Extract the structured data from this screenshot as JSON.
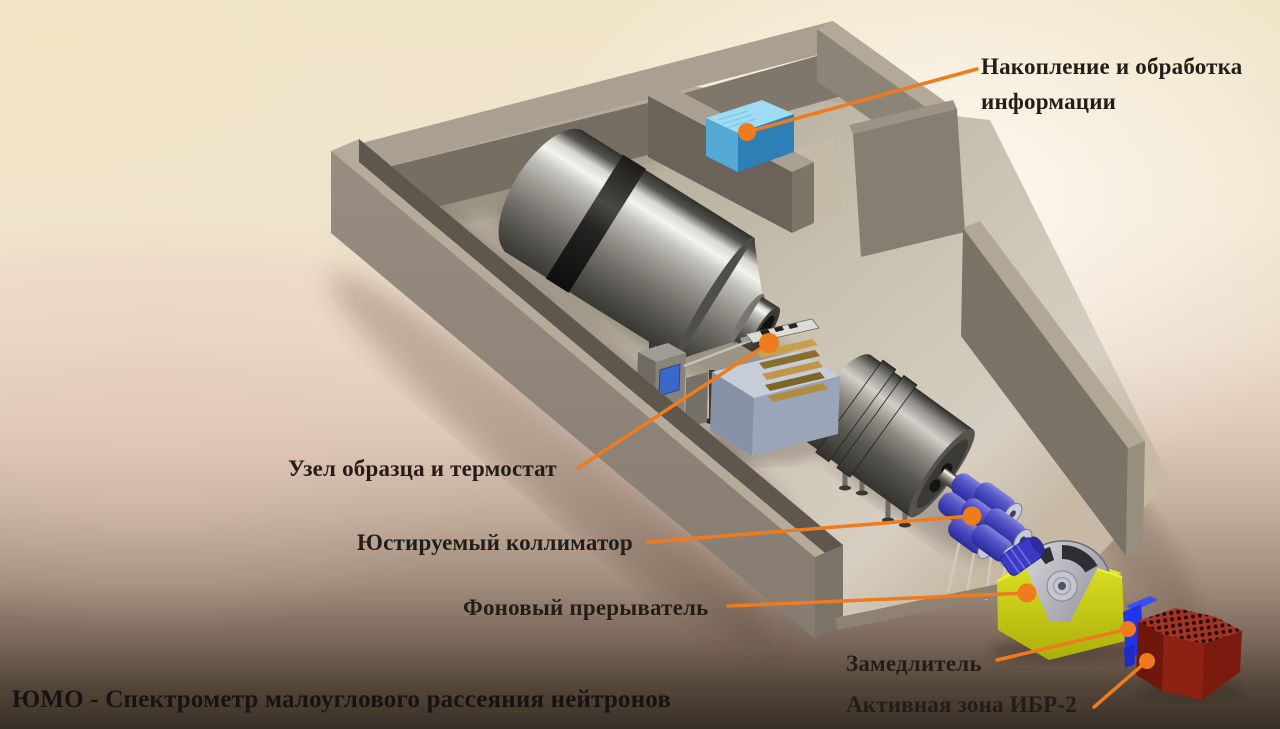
{
  "figure": {
    "title": "ЮМО - Спектрометр малоуглового рассеяния нейтронов",
    "labels": {
      "daq": "Накопление и обработка информации",
      "sample": "Узел образца и термостат",
      "collimator": "Юстируемый коллиматор",
      "chopper": "Фоновый прерыватель",
      "moderator": "Замедлитель",
      "core": "Активная зона ИБР-2"
    },
    "colors": {
      "callout_accent": "#ee7c1e",
      "label_text": "#241d17",
      "background_top": "#f1e5c9",
      "background_bottom": "#39302a",
      "concrete_wall": "#8d8378",
      "hall_floor": "#c9c1b1",
      "detector_tank_metal": "#9a9890",
      "daq_box_blue": "#5bb7e8",
      "collimator_blue": "#4a4ab8",
      "chopper_base_yellow": "#d8dc20",
      "chopper_disc_gray": "#a8a8b0",
      "reactor_core_red": "#8c2114",
      "moderator_blue": "#2135e8",
      "thermostat_gray_blue": "#9aa5b9",
      "sample_stack_brass": "#c09647"
    }
  }
}
